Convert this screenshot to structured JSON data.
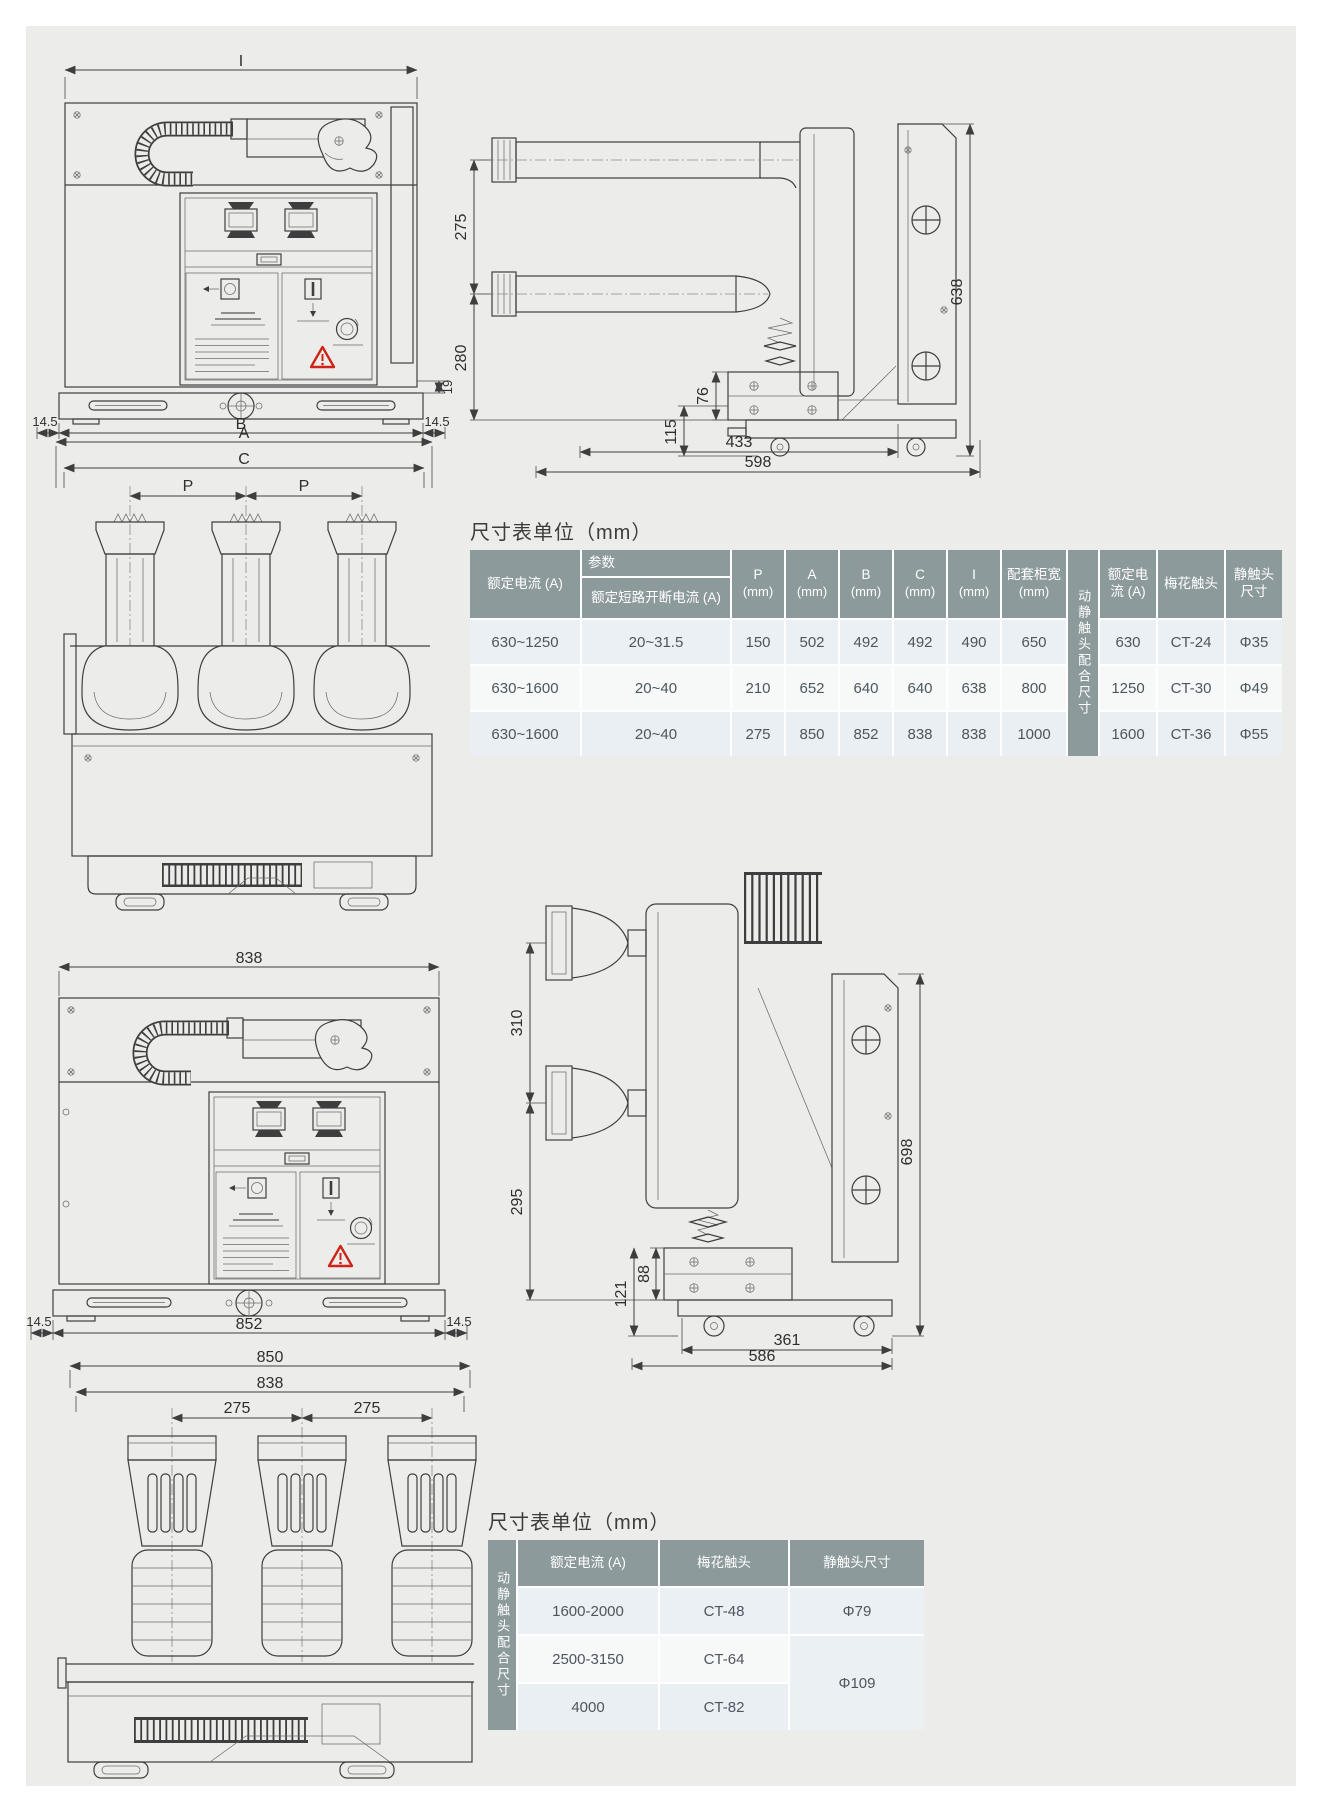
{
  "page": {
    "background": "#ecedeb"
  },
  "table1": {
    "title": "尺寸表单位（mm）",
    "header": {
      "param": "参数",
      "rated_current": "额定电流 (A)",
      "breaking_current": "额定短路开断电流 (A)",
      "p": "P",
      "a": "A",
      "b": "B",
      "c": "C",
      "i": "I",
      "unit": "(mm)",
      "cabinet_width": "配套柜宽",
      "contact_group": "动静触头配合尺寸",
      "rated_current2": "额定电流 (A)",
      "plum_contact": "梅花触头",
      "static_contact": "静触头尺寸"
    },
    "rows": [
      [
        "630~1250",
        "20~31.5",
        "150",
        "502",
        "492",
        "492",
        "490",
        "650",
        "630",
        "CT-24",
        "Φ35"
      ],
      [
        "630~1600",
        "20~40",
        "210",
        "652",
        "640",
        "640",
        "638",
        "800",
        "1250",
        "CT-30",
        "Φ49"
      ],
      [
        "630~1600",
        "20~40",
        "275",
        "850",
        "852",
        "838",
        "838",
        "1000",
        "1600",
        "CT-36",
        "Φ55"
      ]
    ]
  },
  "table2": {
    "title": "尺寸表单位（mm）",
    "header": {
      "contact_group": "动静触头配合尺寸",
      "rated_current": "额定电流 (A)",
      "plum_contact": "梅花触头",
      "static_contact": "静触头尺寸"
    },
    "rows": [
      {
        "current": "1600-2000",
        "plum": "CT-48",
        "static": "Φ79"
      },
      {
        "current": "2500-3150",
        "plum": "CT-64",
        "static": "Φ109"
      },
      {
        "current": "4000",
        "plum": "CT-82"
      }
    ]
  },
  "dims": {
    "front1": {
      "width_top": "I",
      "step": "19",
      "margin_left": "14.5",
      "base_width": "B",
      "margin_right": "14.5"
    },
    "top1": {
      "width_a": "A",
      "width_c": "C",
      "pitch_left": "P",
      "pitch_right": "P"
    },
    "side1": {
      "upper_gap": "275",
      "lower_gap": "280",
      "h115": "115",
      "h76": "76",
      "total_height": "638",
      "depth_inner": "433",
      "depth_total": "598"
    },
    "front2": {
      "width_top": "838",
      "margin_left": "14.5",
      "base_width": "852",
      "margin_right": "14.5"
    },
    "top2": {
      "width_outer": "850",
      "width_inner": "838",
      "pitch_left": "275",
      "pitch_right": "275"
    },
    "side2": {
      "upper_gap": "310",
      "lower_gap": "295",
      "h121": "121",
      "h88": "88",
      "total_height": "698",
      "depth_inner": "361",
      "depth_total": "586"
    }
  }
}
